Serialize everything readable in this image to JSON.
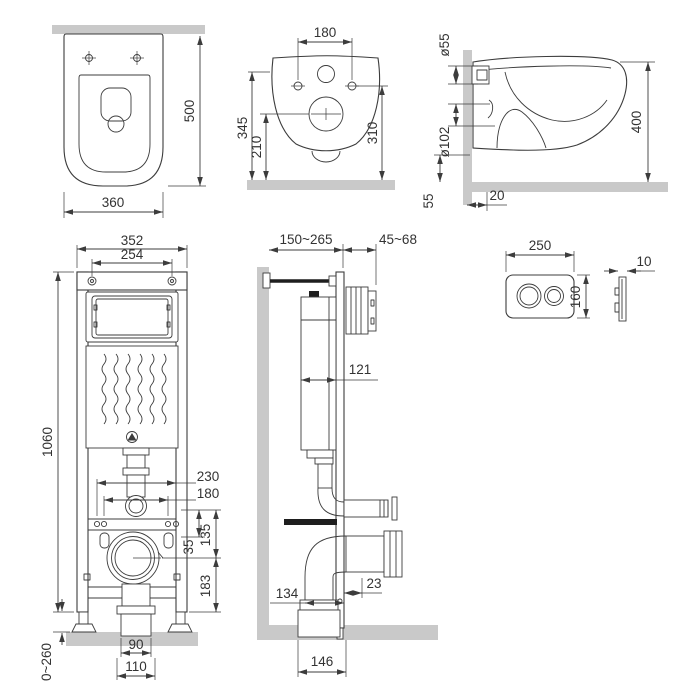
{
  "colors": {
    "line": "#3c3c3c",
    "wall_fill": "#c9c9c9",
    "text": "#333333",
    "background": "#ffffff"
  },
  "views": {
    "toilet_top": {
      "dims": {
        "depth": "500",
        "width": "360"
      }
    },
    "toilet_rear": {
      "dims": {
        "bolt_spacing": "180",
        "height_left": "345",
        "height_drain": "210",
        "height_right": "310"
      }
    },
    "toilet_side": {
      "dims": {
        "inlet": "ø55",
        "outlet": "ø102",
        "depth": "400",
        "bottom": "55",
        "offset": "20"
      }
    },
    "frame_front": {
      "dims": {
        "width": "352",
        "inner_width": "254",
        "height": "1060",
        "spacing_outer": "230",
        "spacing_inner": "180",
        "d135": "135",
        "d35": "35",
        "d183": "183",
        "legs": "0~260",
        "d90": "90",
        "d110": "110"
      }
    },
    "frame_side": {
      "dims": {
        "depth_range": "150~265",
        "plate_range": "45~68",
        "tank": "121",
        "d23": "23",
        "d134": "134",
        "d146": "146"
      }
    },
    "flush_plate": {
      "dims": {
        "width": "250",
        "height": "160",
        "thickness": "10"
      }
    }
  }
}
